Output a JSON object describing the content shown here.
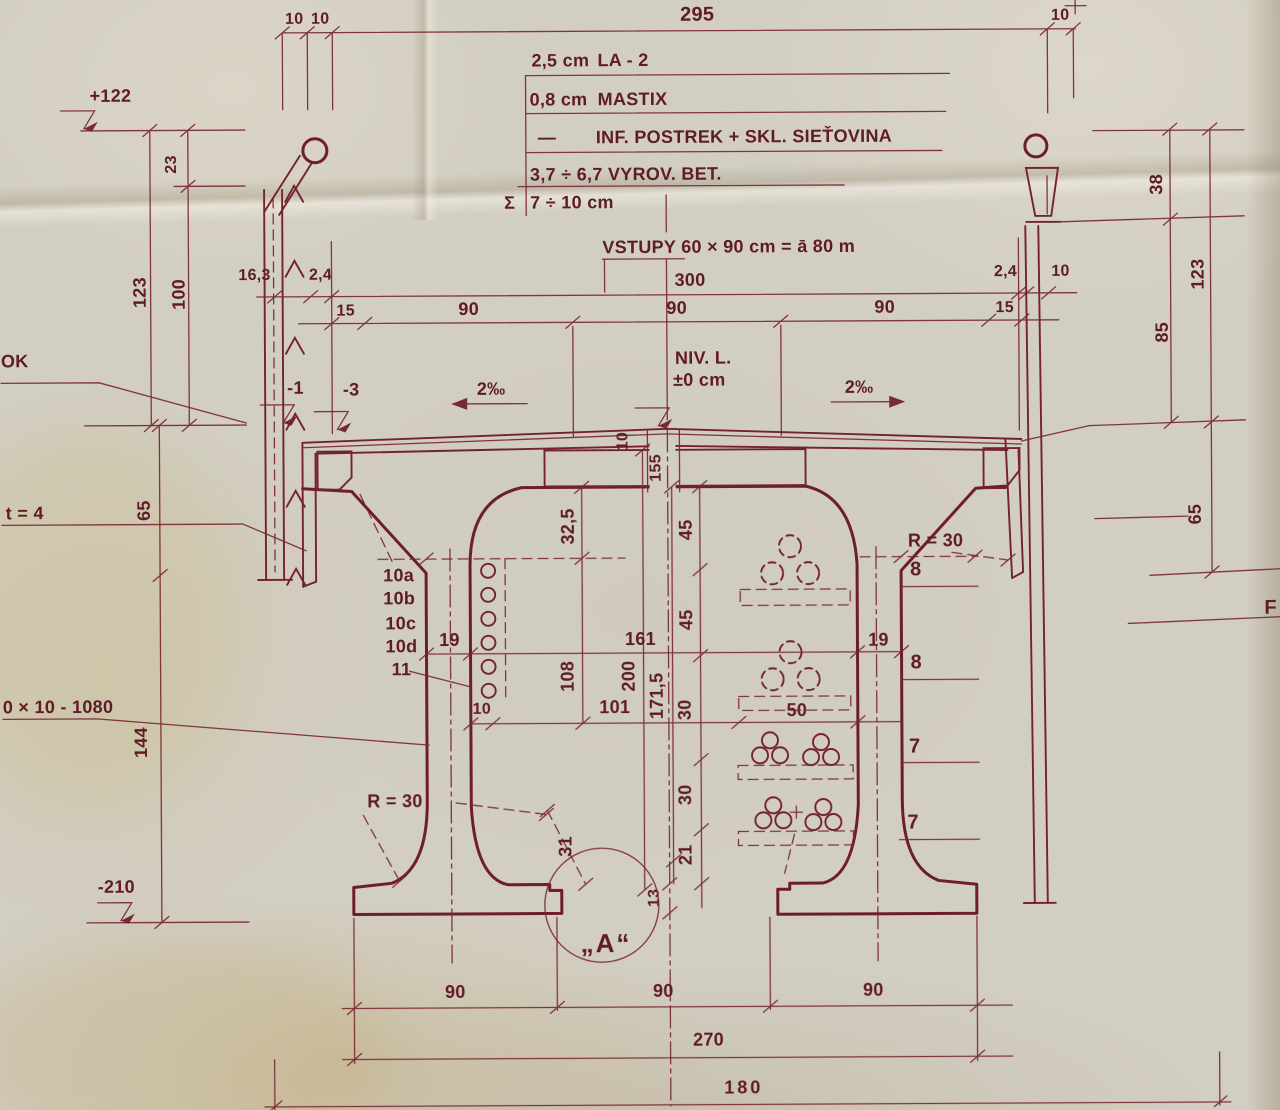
{
  "drawing": {
    "kind": "bridge girder cross-section blueprint"
  },
  "colors": {
    "ink": "#6e1e2a",
    "paper": "#d2cec1"
  },
  "notes": {
    "l1a": "2,5 cm",
    "l1b": "LA - 2",
    "l2a": "0,8 cm",
    "l2b": "MASTIX",
    "l3a": "—",
    "l3b": "INF. POSTREK + SKL. SIEŤOVINA",
    "l4": "3,7 ÷ 6,7 VYROV. BET.",
    "sigma": "Σ",
    "l5": "7 ÷ 10 cm",
    "vstupy": "VSTUPY  60 × 90 cm  =  ā 80 m"
  },
  "top": {
    "t10a": "10",
    "t10b": "10",
    "t295": "295",
    "t10c": "10"
  },
  "deck": {
    "c163": "16,3",
    "c24l": "2,4",
    "c300": "300",
    "c24r": "2,4",
    "c10r": "10",
    "c15l": "15",
    "c90a": "90",
    "c90b": "90",
    "c90c": "90",
    "c15r": "15",
    "niv1": "NIV. L.",
    "niv2": "±0 cm",
    "slopeL": "2‰",
    "slopeR": "2‰",
    "m3": "-3",
    "p10": "10",
    "p155": "155"
  },
  "left": {
    "p122": "+122",
    "d23": "23",
    "d123": "123",
    "d100": "100",
    "ok": "OK",
    "m1": "-1",
    "t4": "t = 4",
    "d65": "65",
    "plate": "0 × 10 - 1080",
    "d144": "144",
    "m210": "-210",
    "r30": "R = 30"
  },
  "right": {
    "d38": "38",
    "d123": "123",
    "d85": "85",
    "d65": "65",
    "f": "F",
    "r30": "R = 30",
    "b8a": "8",
    "b8b": "8",
    "b7a": "7",
    "b7b": "7"
  },
  "web": {
    "bars": [
      "10a",
      "10b",
      "10c",
      "10d",
      "11"
    ],
    "d19l": "19",
    "d19r": "19",
    "d161": "161",
    "d108": "108",
    "d200": "200",
    "d1715": "171,5",
    "d101": "101",
    "d10": "10",
    "d50": "50",
    "d325": "32,5",
    "d45a": "45",
    "d45b": "45",
    "d30a": "30",
    "d30b": "30",
    "d21": "21",
    "d13": "13",
    "d31": "31"
  },
  "bottom": {
    "b90a": "90",
    "b90b": "90",
    "b90c": "90",
    "b270": "270",
    "b180": "180",
    "detail": "„A“"
  }
}
